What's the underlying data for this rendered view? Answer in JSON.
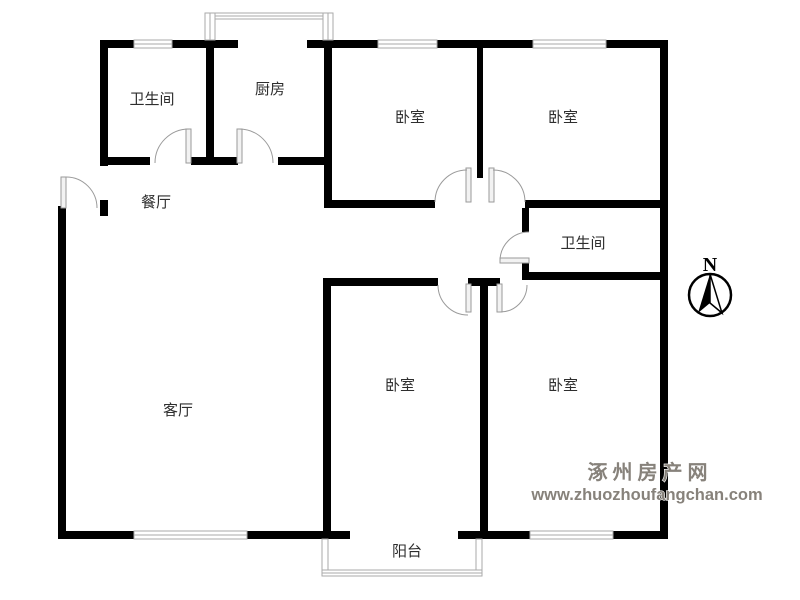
{
  "plan": {
    "background_color": "#ffffff",
    "wall_color": "#000000",
    "door_color": "#9a9a9a",
    "window_color": "#aaaaaa",
    "label_color": "#2e2e2e"
  },
  "rooms": {
    "bathroom_top_left": {
      "label": "卫生间"
    },
    "kitchen": {
      "label": "厨房"
    },
    "bedroom_top_middle": {
      "label": "卧室"
    },
    "bedroom_top_right": {
      "label": "卧室"
    },
    "dining_room": {
      "label": "餐厅"
    },
    "bathroom_middle_right": {
      "label": "卫生间"
    },
    "living_room": {
      "label": "客厅"
    },
    "bedroom_bottom_middle": {
      "label": "卧室"
    },
    "bedroom_bottom_right": {
      "label": "卧室"
    },
    "balcony": {
      "label": "阳台"
    }
  },
  "compass": {
    "label": "N"
  },
  "watermark": {
    "site_name": "涿州房产网",
    "site_url": "www.zhuozhoufangchan.com",
    "color": "#87827b"
  }
}
